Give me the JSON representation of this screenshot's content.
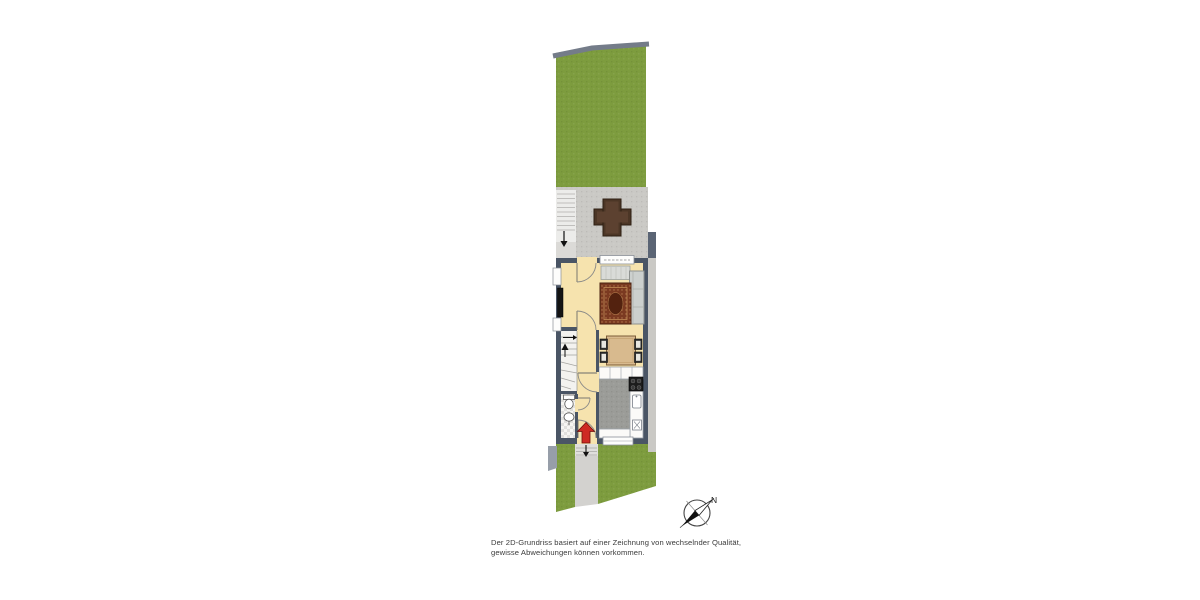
{
  "disclaimer": {
    "line1": "Der 2D-Grundriss basiert auf einer Zeichnung von wechselnder Qualität,",
    "line2": "gewisse Abweichungen können vorkommen."
  },
  "compass": {
    "north_label": "N"
  },
  "colors": {
    "grass": "#7d9c3e",
    "paving": "#cac9c5",
    "path": "#d3d2cf",
    "fence": "#747c89",
    "wall": "#4a5565",
    "floor": "#f6e3ae",
    "kitchen_floor": "#9b9c98",
    "white_fixture": "#fbfaf8",
    "stairs": "#f3f2ef",
    "rug": "#7b3a21",
    "sofa": "#ccd0ce",
    "dining_table": "#d8ba8e",
    "terrace_table": "#4c3626",
    "entrance_arrow": "#ce2a23"
  },
  "floorplan": {
    "rooms": [
      "back-garden",
      "terrace",
      "living-room",
      "dining-area",
      "kitchen",
      "hallway",
      "staircase",
      "bathroom",
      "entrance-path",
      "front-garden"
    ],
    "furniture": [
      "terrace-cross-table",
      "sofa",
      "area-rug",
      "sideboard",
      "tv-board",
      "dining-table",
      "dining-chairs",
      "stove",
      "kitchen-sink",
      "toilet",
      "wash-basin"
    ]
  }
}
